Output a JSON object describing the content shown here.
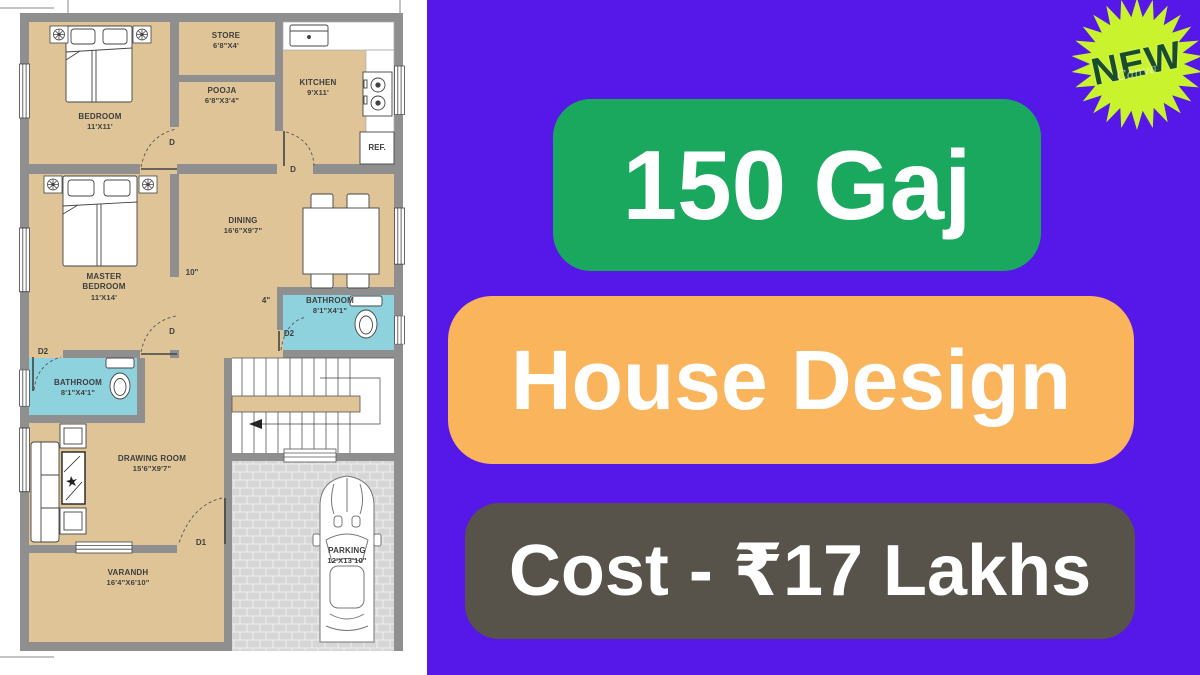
{
  "colors": {
    "panel_bg": "#5617e9",
    "banner_green": "#1aa85e",
    "banner_orange": "#f9b45c",
    "banner_gray": "#57524a",
    "badge_star": "#c9f42d",
    "badge_text": "#1a4d2e",
    "wall": "#8f8f8f",
    "room_fill": "#dec497",
    "bathroom_fill": "#8ed2de"
  },
  "badge": {
    "label": "NEW",
    "watermark": "Canva"
  },
  "banners": [
    {
      "label": "150 Gaj"
    },
    {
      "label": "House Design"
    },
    {
      "label": "Cost - ₹17 Lakhs"
    }
  ],
  "plan": {
    "rooms": {
      "bedroom": {
        "name": "BEDROOM",
        "dims": "11'X11'"
      },
      "store": {
        "name": "STORE",
        "dims": "6'8\"X4'"
      },
      "pooja": {
        "name": "POOJA",
        "dims": "6'8\"X3'4\""
      },
      "kitchen": {
        "name": "KITCHEN",
        "dims": "9'X11'"
      },
      "dining": {
        "name": "DINING",
        "dims": "16'6\"X9'7\""
      },
      "master_bedroom": {
        "name": "MASTER BEDROOM",
        "dims": "11'X14'"
      },
      "bathroom_right": {
        "name": "BATHROOM",
        "dims": "8'1\"X4'1\""
      },
      "bathroom_left": {
        "name": "BATHROOM",
        "dims": "8'1\"X4'1\""
      },
      "drawing_room": {
        "name": "DRAWING ROOM",
        "dims": "15'6\"X9'7\""
      },
      "varandh": {
        "name": "VARANDH",
        "dims": "16'4\"X6'10\""
      },
      "parking": {
        "name": "PARKING",
        "dims": "12'X13'10\""
      }
    },
    "labels": {
      "ref": "REF.",
      "door_d": "D",
      "door_d1": "D1",
      "door_d2": "D2",
      "wall_10": "10\"",
      "wall_4": "4\""
    }
  }
}
